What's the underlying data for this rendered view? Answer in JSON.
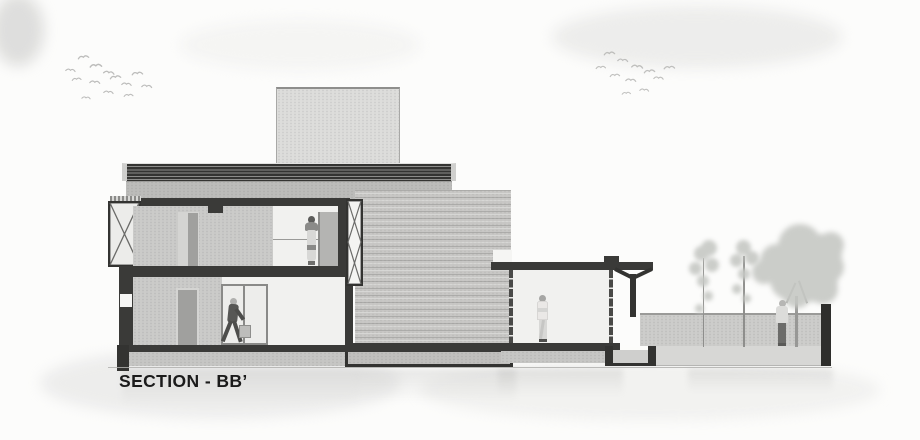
{
  "title": {
    "label": "SECTION - BB’"
  },
  "palette": {
    "ink": "#333331",
    "section_cut": "#3a3a38",
    "wall_gray": "#cbcbc9",
    "brick_gray": "#c8c7c5",
    "room_white": "#f1f1ef",
    "parapet_gray": "#bcbcba",
    "tower_gray": "#dddddb",
    "plinth_gray": "#c6c6c4",
    "garden_gray": "#cdcdcb",
    "foliage_gray": "#c6c8c4",
    "bird_gray": "#b2b2b0",
    "background": "#fcfcfb",
    "title_color": "#1b1b1b"
  },
  "scene": {
    "figures": [
      "woman-standing-upper-floor",
      "man-walking-with-bag-ground-floor",
      "man-standing-pavilion",
      "person-standing-garden"
    ],
    "trees": {
      "saplings": 2,
      "large_trees": 1
    },
    "bird_flocks": 2
  }
}
